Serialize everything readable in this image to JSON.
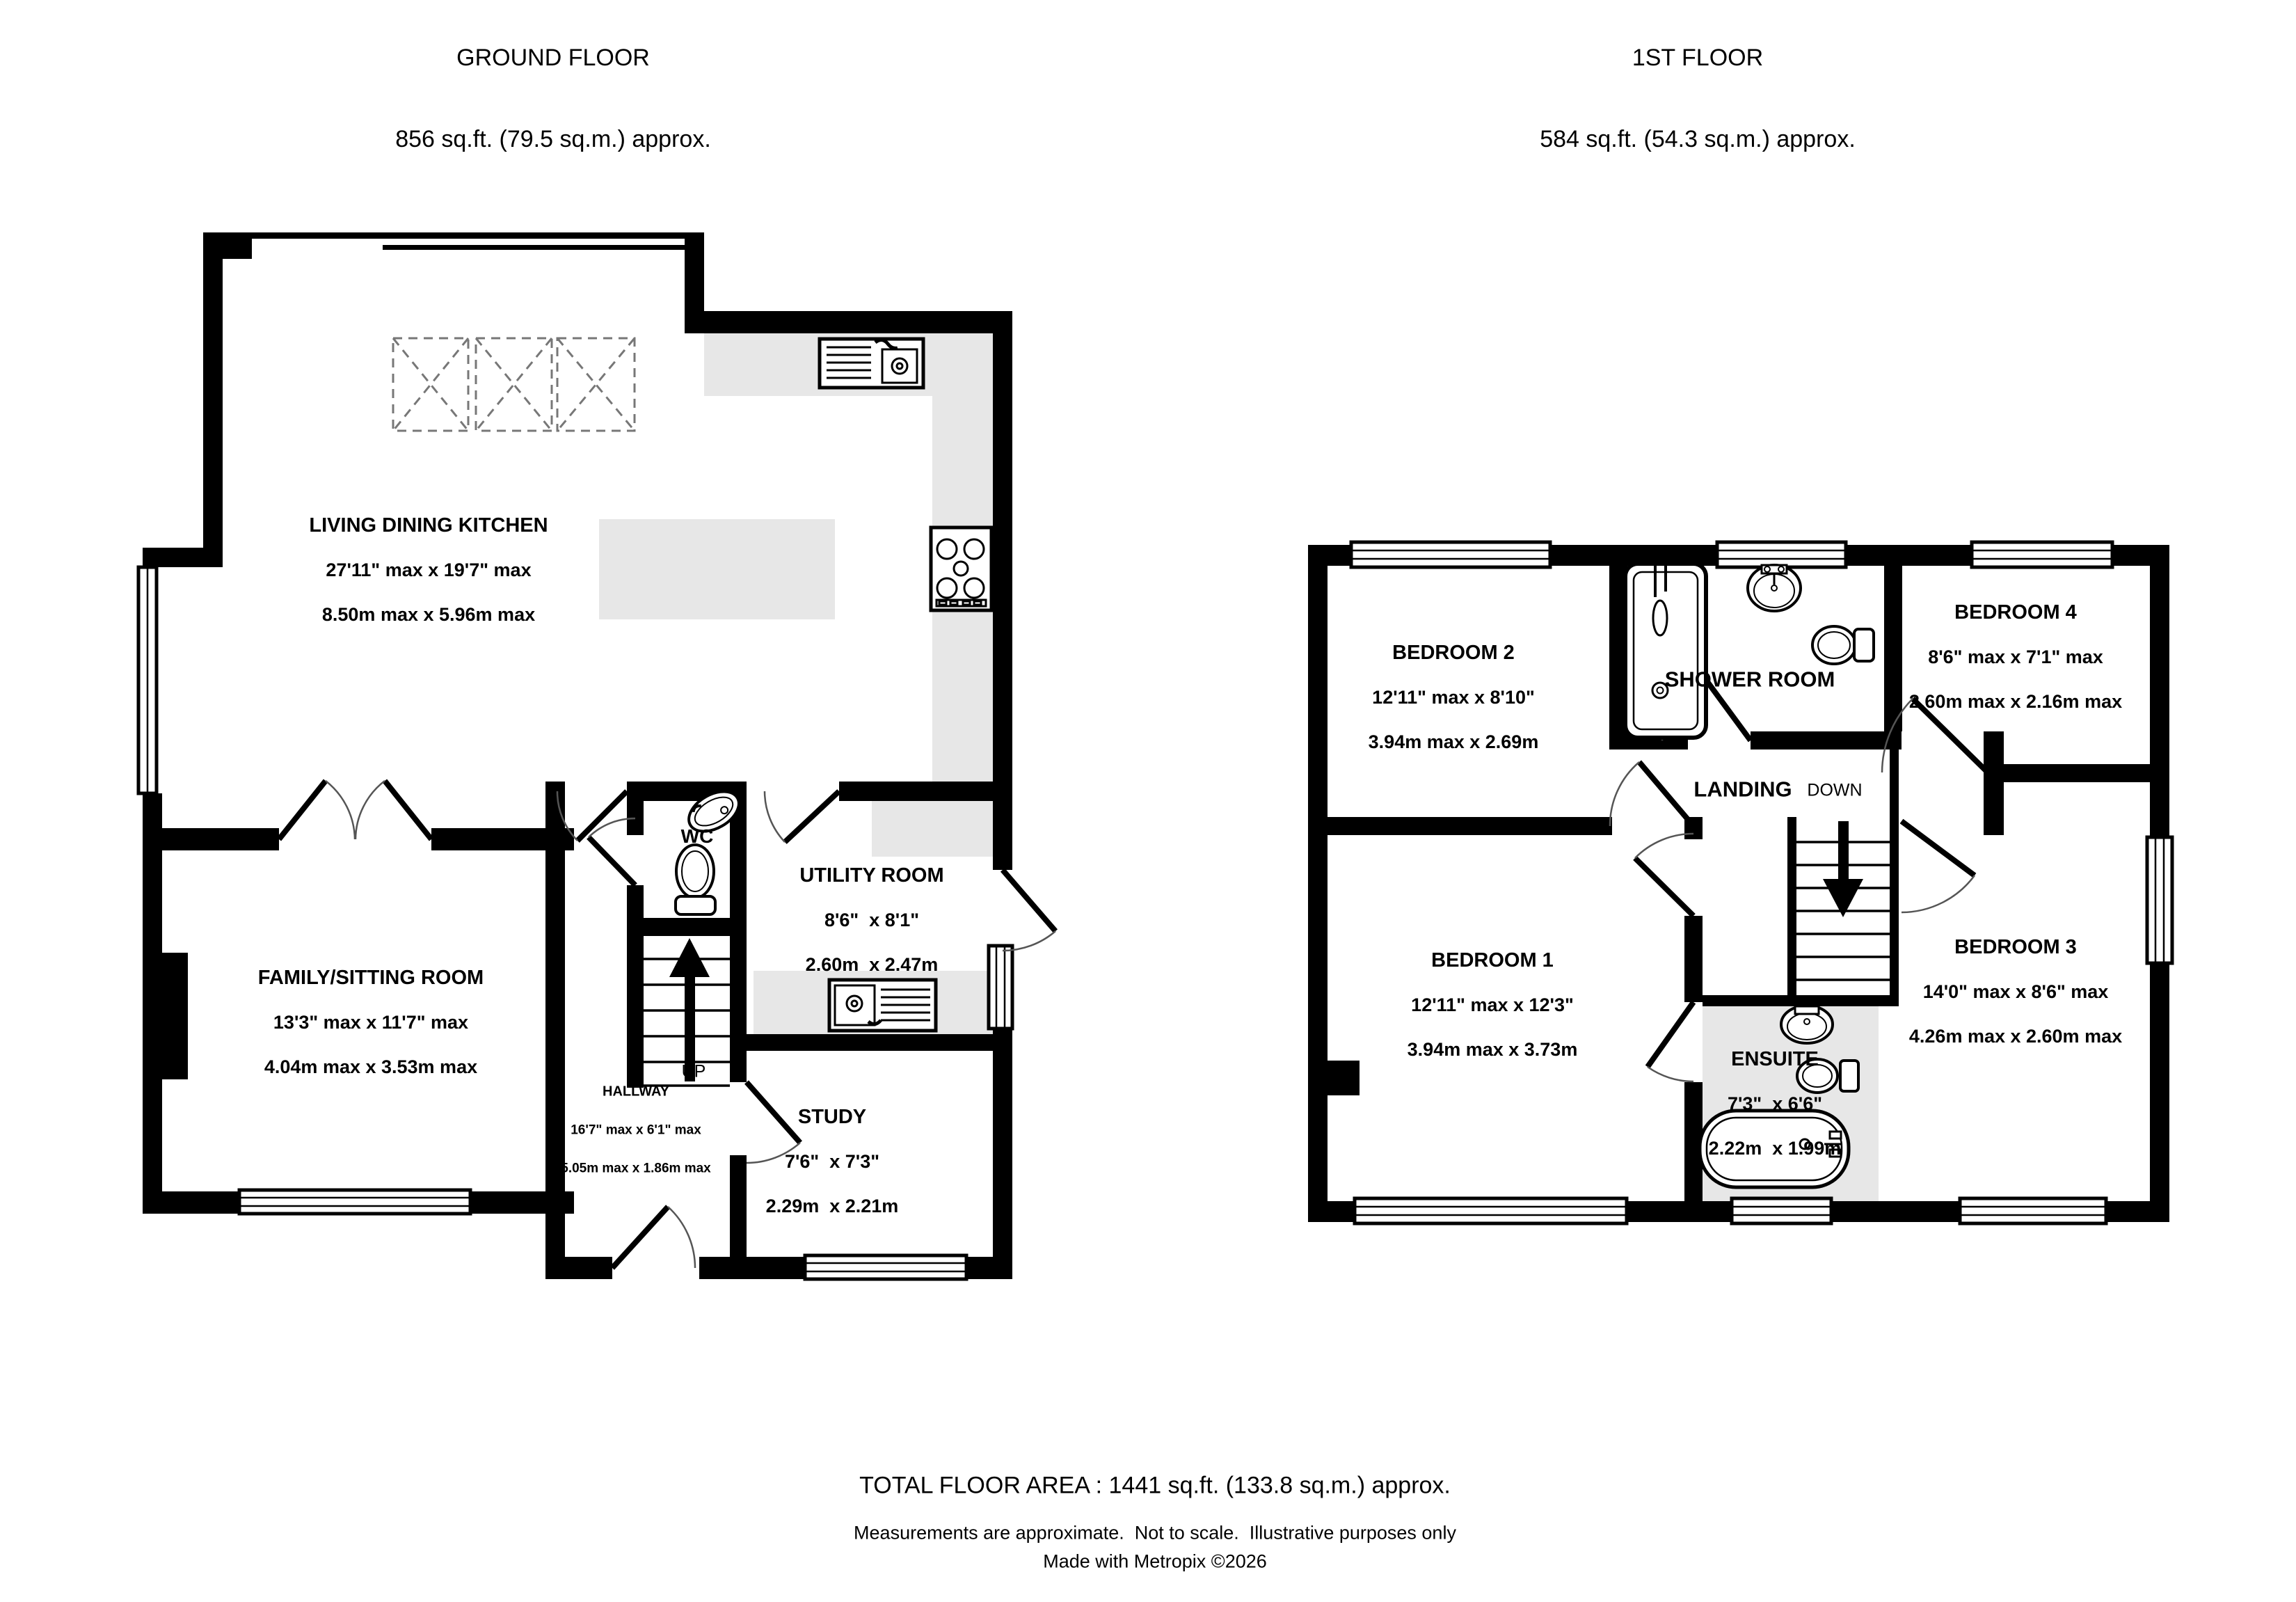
{
  "ground_floor": {
    "title": "GROUND FLOOR",
    "area": "856 sq.ft. (79.5 sq.m.) approx.",
    "rooms": {
      "living": {
        "name": "LIVING DINING KITCHEN",
        "imperial": "27'11\" max x 19'7\" max",
        "metric": "8.50m max x 5.96m max"
      },
      "family": {
        "name": "FAMILY/SITTING ROOM",
        "imperial": "13'3\" max x 11'7\" max",
        "metric": "4.04m max x 3.53m max"
      },
      "utility": {
        "name": "UTILITY ROOM",
        "imperial": "8'6\"  x 8'1\"",
        "metric": "2.60m  x 2.47m"
      },
      "study": {
        "name": "STUDY",
        "imperial": "7'6\"  x 7'3\"",
        "metric": "2.29m  x 2.21m"
      },
      "hallway": {
        "name": "HALLWAY",
        "imperial": "16'7\" max x 6'1\" max",
        "metric": "5.05m max x 1.86m max"
      },
      "wc": "WC",
      "up": "UP"
    }
  },
  "first_floor": {
    "title": "1ST FLOOR",
    "area": "584 sq.ft. (54.3 sq.m.) approx.",
    "rooms": {
      "bedroom1": {
        "name": "BEDROOM 1",
        "imperial": "12'11\" max x 12'3\"",
        "metric": "3.94m max x 3.73m"
      },
      "bedroom2": {
        "name": "BEDROOM 2",
        "imperial": "12'11\" max x 8'10\"",
        "metric": "3.94m max x 2.69m"
      },
      "bedroom3": {
        "name": "BEDROOM 3",
        "imperial": "14'0\" max x 8'6\" max",
        "metric": "4.26m max x 2.60m max"
      },
      "bedroom4": {
        "name": "BEDROOM 4",
        "imperial": "8'6\" max x 7'1\" max",
        "metric": "2.60m max x 2.16m max"
      },
      "ensuite": {
        "name": "ENSUITE",
        "imperial": "7'3\"  x 6'6\"",
        "metric": "2.22m  x 1.99m"
      },
      "shower_room": "SHOWER ROOM",
      "landing": "LANDING",
      "down": "DOWN"
    }
  },
  "footer": {
    "total": "TOTAL FLOOR AREA : 1441 sq.ft. (133.8 sq.m.) approx.",
    "disclaimer": "Measurements are approximate.  Not to scale.  Illustrative purposes only",
    "credit": "Made with Metropix ©2026"
  },
  "colors": {
    "wall": "#000000",
    "counter": "#e7e7e7"
  }
}
